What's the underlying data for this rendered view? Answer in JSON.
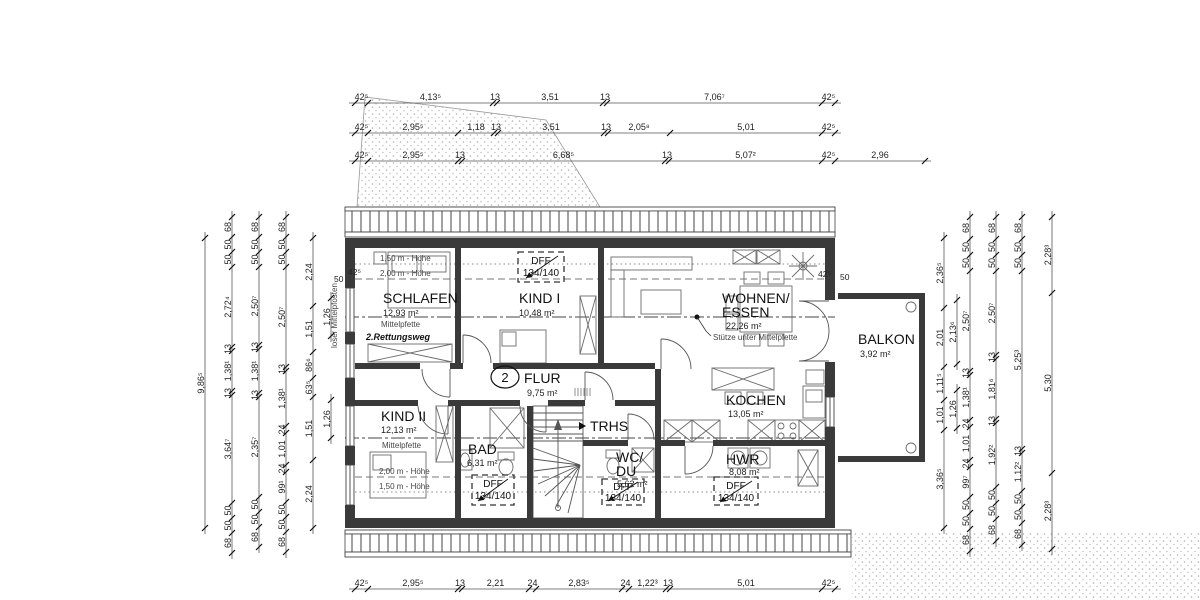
{
  "drawing": {
    "type": "floor-plan",
    "level_number": "2"
  },
  "rooms": {
    "schlafen": {
      "name": "SCHLAFEN",
      "area": "12,93 m²"
    },
    "kind1": {
      "name": "KIND I",
      "area": "10,48 m²"
    },
    "wohnen": {
      "name_line1": "WOHNEN/",
      "name_line2": "ESSEN",
      "area": "22,26 m²"
    },
    "balkon": {
      "name": "BALKON",
      "area": "3,92 m²"
    },
    "kind2": {
      "name": "KIND II",
      "area": "12,13 m²"
    },
    "bad": {
      "name": "BAD",
      "area": "6,31 m²"
    },
    "flur": {
      "name": "FLUR",
      "area": "9,75 m²",
      "level_number": "2"
    },
    "trhs": {
      "name": "TRHS"
    },
    "wcdu": {
      "name_line1": "WC/",
      "name_line2": "DU",
      "area": "5,62 m²"
    },
    "kochen": {
      "name": "KOCHEN",
      "area": "13,05 m²"
    },
    "hwr": {
      "name": "HWR",
      "area": "8,08 m²"
    }
  },
  "annotations": {
    "hoehe_150": "1,50 m - Höhe",
    "hoehe_200": "2,00 m - Höhe",
    "mittelpfette": "Mittelpfette",
    "rettungsweg": "2.Rettungsweg",
    "loser_mittelpfosten": "loser Mittelpfosten",
    "stuetze": "Stütze unter Mittelpfette",
    "dff_label": "DFF",
    "dff_size": "134/140"
  },
  "wall_dims": {
    "tl_thickness": "42⁵",
    "tl_offset": "50",
    "balcony_thickness": "42⁵",
    "balcony_offset": "50"
  },
  "dimensions": {
    "chains": [
      {
        "id": "top1",
        "o": "h",
        "x": 355,
        "y": 103,
        "segs": [
          [
            "42⁵",
            13
          ],
          [
            "4,13⁵",
            125
          ],
          [
            "13",
            4
          ],
          [
            "3,51",
            106
          ],
          [
            "13",
            4
          ],
          [
            "7,06⁷",
            215
          ],
          [
            "42⁵",
            13
          ]
        ]
      },
      {
        "id": "top2",
        "o": "h",
        "x": 355,
        "y": 133,
        "segs": [
          [
            "42⁵",
            13
          ],
          [
            "2,95⁵",
            90
          ],
          [
            "1,18",
            36
          ],
          [
            "13",
            4
          ],
          [
            "3,51",
            106
          ],
          [
            "13",
            4
          ],
          [
            "2,05⁸",
            62
          ],
          [
            "5,01",
            152
          ],
          [
            "42⁵",
            13
          ]
        ]
      },
      {
        "id": "top3",
        "o": "h",
        "x": 355,
        "y": 161,
        "segs": [
          [
            "42⁵",
            13
          ],
          [
            "2,95⁵",
            90
          ],
          [
            "13",
            4
          ],
          [
            "6,68⁵",
            203
          ],
          [
            "13",
            4
          ],
          [
            "5,07²",
            153
          ],
          [
            "42⁵",
            13
          ],
          [
            "2,96",
            90
          ]
        ]
      },
      {
        "id": "bottom",
        "o": "h",
        "x": 355,
        "y": 589,
        "segs": [
          [
            "42⁵",
            13
          ],
          [
            "2,95⁵",
            90
          ],
          [
            "13",
            4
          ],
          [
            "2,21",
            67
          ],
          [
            "24",
            7
          ],
          [
            "2,83⁵",
            86
          ],
          [
            "24",
            7
          ],
          [
            "1,22³",
            37
          ],
          [
            "13",
            4
          ],
          [
            "5,01",
            152
          ],
          [
            "42⁵",
            13
          ]
        ]
      },
      {
        "id": "left1",
        "o": "v",
        "x": 205,
        "y": 238,
        "segs": [
          [
            "9,86⁵",
            290
          ]
        ]
      },
      {
        "id": "left2",
        "o": "v",
        "x": 232,
        "y": 217,
        "segs": [
          [
            "68",
            20
          ],
          [
            "50",
            15
          ],
          [
            "50",
            15
          ],
          [
            "2,72⁴",
            80
          ],
          [
            "13",
            4
          ],
          [
            "1,38¹",
            40
          ],
          [
            "13",
            4
          ],
          [
            "3,64⁷",
            108
          ],
          [
            "50",
            15
          ],
          [
            "50",
            15
          ],
          [
            "68",
            20
          ]
        ]
      },
      {
        "id": "left3",
        "o": "v",
        "x": 259,
        "y": 217,
        "segs": [
          [
            "68",
            20
          ],
          [
            "50",
            15
          ],
          [
            "50",
            15
          ],
          [
            "2,50⁷",
            78
          ],
          [
            "13",
            4
          ],
          [
            "1,38¹",
            44
          ],
          [
            "13",
            4
          ],
          [
            "2,35⁷",
            100
          ],
          [
            "50",
            15
          ],
          [
            "50",
            15
          ],
          [
            "68",
            20
          ]
        ]
      },
      {
        "id": "left4",
        "o": "v",
        "x": 286,
        "y": 217,
        "segs": [
          [
            "68",
            20
          ],
          [
            "50",
            15
          ],
          [
            "50",
            15
          ],
          [
            "2,50⁷",
            100
          ],
          [
            "13",
            4
          ],
          [
            "1,38¹",
            55
          ],
          [
            "24",
            7
          ],
          [
            "1,01",
            32
          ],
          [
            "24",
            7
          ],
          [
            "99¹",
            30
          ],
          [
            "50",
            15
          ],
          [
            "50",
            15
          ],
          [
            "68",
            20
          ]
        ]
      },
      {
        "id": "left5",
        "o": "v",
        "x": 313,
        "y": 238,
        "segs": [
          [
            "2,24",
            68
          ],
          [
            "1,51",
            46
          ],
          [
            "86⁶",
            26
          ],
          [
            "63⁵",
            19
          ],
          [
            "1,51",
            63
          ],
          [
            "2,24",
            68
          ]
        ]
      },
      {
        "id": "left6a",
        "o": "v",
        "x": 331,
        "y": 298,
        "segs": [
          [
            "1,26",
            38
          ]
        ]
      },
      {
        "id": "left6b",
        "o": "v",
        "x": 331,
        "y": 400,
        "segs": [
          [
            "1,26",
            38
          ]
        ]
      },
      {
        "id": "right1",
        "o": "v",
        "x": 944,
        "y": 238,
        "segs": [
          [
            "2,36⁵",
            70
          ],
          [
            "2,01",
            59
          ],
          [
            "1,11⁵",
            33
          ],
          [
            "1,01",
            30
          ],
          [
            "3,36⁵",
            98
          ]
        ]
      },
      {
        "id": "right1b",
        "o": "v",
        "x": 957,
        "y": 300,
        "segs": [
          [
            "2,13⁶",
            64
          ]
        ]
      },
      {
        "id": "right1c",
        "o": "v",
        "x": 957,
        "y": 390,
        "segs": [
          [
            "1,26",
            38
          ]
        ]
      },
      {
        "id": "right2",
        "o": "v",
        "x": 970,
        "y": 217,
        "segs": [
          [
            "68",
            22
          ],
          [
            "50",
            16
          ],
          [
            "50",
            16
          ],
          [
            "2,50⁷",
            100
          ],
          [
            "13",
            4
          ],
          [
            "1,38¹",
            45
          ],
          [
            "24",
            7
          ],
          [
            "1,01",
            33
          ],
          [
            "24",
            7
          ],
          [
            "99⁷",
            30
          ],
          [
            "50",
            16
          ],
          [
            "50",
            16
          ],
          [
            "68",
            22
          ]
        ]
      },
      {
        "id": "right3",
        "o": "v",
        "x": 996,
        "y": 217,
        "segs": [
          [
            "68",
            22
          ],
          [
            "50",
            16
          ],
          [
            "50",
            16
          ],
          [
            "2,50⁷",
            84
          ],
          [
            "13",
            4
          ],
          [
            "1,81⁶",
            60
          ],
          [
            "13",
            4
          ],
          [
            "1,92²",
            64
          ],
          [
            "50",
            16
          ],
          [
            "50",
            16
          ],
          [
            "68",
            22
          ]
        ]
      },
      {
        "id": "right4",
        "o": "v",
        "x": 1022,
        "y": 217,
        "segs": [
          [
            "68",
            22
          ],
          [
            "50",
            16
          ],
          [
            "50",
            16
          ],
          [
            "5,25³",
            178
          ],
          [
            "13",
            4
          ],
          [
            "1,12²",
            38
          ],
          [
            "50",
            16
          ],
          [
            "50",
            16
          ],
          [
            "68",
            22
          ]
        ]
      },
      {
        "id": "right5",
        "o": "v",
        "x": 1052,
        "y": 217,
        "segs": [
          [
            "2,28³",
            76
          ],
          [
            "5,30",
            180
          ],
          [
            "2,28³",
            76
          ]
        ]
      }
    ]
  }
}
